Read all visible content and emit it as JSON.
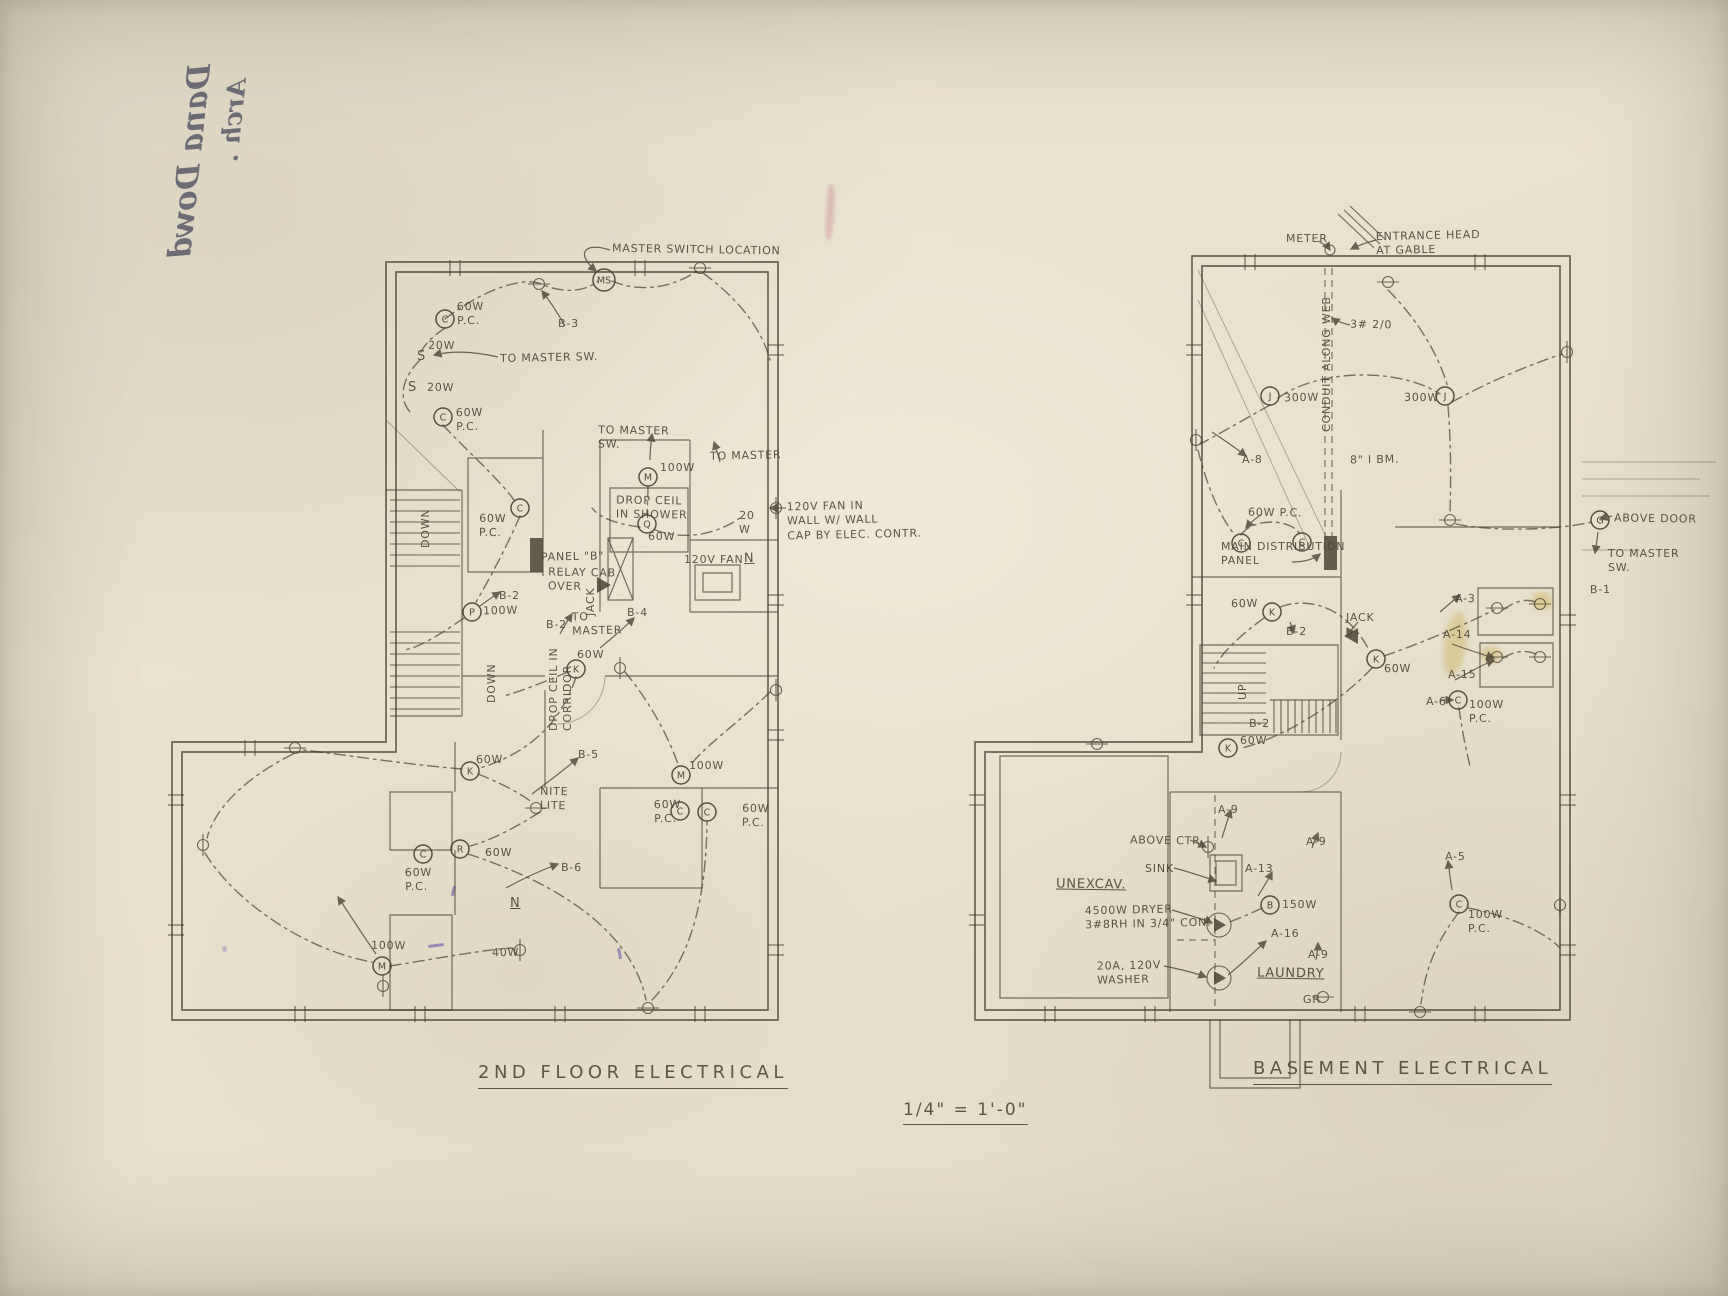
{
  "sheet": {
    "scale_note": "1/4\" = 1'-0\"",
    "handwriting_line1": "Dana Dowd",
    "handwriting_line2": "Arch ."
  },
  "colors": {
    "paper": "#e9e2cf",
    "ink": "#4a4433",
    "stain_yellow": "#c9a33f",
    "ink_purple": "#5a48a8",
    "stamp_pink": "#c06678"
  },
  "plans": [
    {
      "title": "2ND FLOOR ELECTRICAL",
      "labels": [
        {
          "t": "MASTER SWITCH LOCATION",
          "x": 612,
          "y": 243
        },
        {
          "t": "B-3",
          "x": 558,
          "y": 317
        },
        {
          "t": "60W\nP.C.",
          "x": 457,
          "y": 300
        },
        {
          "t": "20W",
          "x": 428,
          "y": 339
        },
        {
          "t": "S",
          "x": 417,
          "y": 349,
          "c": "big"
        },
        {
          "t": "TO MASTER SW.",
          "x": 500,
          "y": 351
        },
        {
          "t": "20W",
          "x": 427,
          "y": 381
        },
        {
          "t": "S",
          "x": 408,
          "y": 380,
          "c": "big"
        },
        {
          "t": "60W\nP.C.",
          "x": 456,
          "y": 406
        },
        {
          "t": "TO MASTER\nSW.",
          "x": 598,
          "y": 424
        },
        {
          "t": "100W",
          "x": 660,
          "y": 461
        },
        {
          "t": "TO MASTER",
          "x": 710,
          "y": 449
        },
        {
          "t": "DROP CEIL\nIN SHOWER",
          "x": 616,
          "y": 494
        },
        {
          "t": "60W",
          "x": 648,
          "y": 530
        },
        {
          "t": "120V FAN IN\nWALL W/ WALL\nCAP BY ELEC. CONTR.",
          "x": 787,
          "y": 499
        },
        {
          "t": "20\nW",
          "x": 739,
          "y": 509
        },
        {
          "t": "120V FAN",
          "x": 684,
          "y": 553
        },
        {
          "t": "N",
          "x": 744,
          "y": 551,
          "c": "big u"
        },
        {
          "t": "60W\nP.C.",
          "x": 479,
          "y": 512
        },
        {
          "t": "DOWN",
          "x": 419,
          "y": 548,
          "c": "v"
        },
        {
          "t": "PANEL \"B\"",
          "x": 541,
          "y": 550
        },
        {
          "t": "RELAY CAB.\nOVER",
          "x": 548,
          "y": 566
        },
        {
          "t": "B-2",
          "x": 499,
          "y": 589
        },
        {
          "t": "100W",
          "x": 483,
          "y": 604
        },
        {
          "t": "JACK",
          "x": 584,
          "y": 616,
          "c": "v"
        },
        {
          "t": "B-2",
          "x": 546,
          "y": 618
        },
        {
          "t": "TO\nMASTER",
          "x": 572,
          "y": 610
        },
        {
          "t": "B-4",
          "x": 627,
          "y": 606
        },
        {
          "t": "60W",
          "x": 577,
          "y": 648
        },
        {
          "t": "DROP CEIL IN\nCORRIDOR",
          "x": 547,
          "y": 731,
          "c": "v"
        },
        {
          "t": "DOWN",
          "x": 485,
          "y": 703,
          "c": "v"
        },
        {
          "t": "B-5",
          "x": 578,
          "y": 748
        },
        {
          "t": "60W",
          "x": 476,
          "y": 753
        },
        {
          "t": "NITE\nLITE",
          "x": 540,
          "y": 785
        },
        {
          "t": "100W",
          "x": 689,
          "y": 759
        },
        {
          "t": "60W\nP.C.",
          "x": 654,
          "y": 798
        },
        {
          "t": "60W\nP.C.",
          "x": 742,
          "y": 802
        },
        {
          "t": "60W",
          "x": 485,
          "y": 846
        },
        {
          "t": "60W\nP.C.",
          "x": 405,
          "y": 866
        },
        {
          "t": "B-6",
          "x": 561,
          "y": 861
        },
        {
          "t": "N",
          "x": 510,
          "y": 896,
          "c": "big u"
        },
        {
          "t": "40W",
          "x": 492,
          "y": 946
        },
        {
          "t": "100W",
          "x": 371,
          "y": 939
        }
      ],
      "fixtures": [
        {
          "l": "C",
          "x": 445,
          "y": 319
        },
        {
          "l": "MS",
          "x": 604,
          "y": 280,
          "r": 11
        },
        {
          "l": "C",
          "x": 443,
          "y": 417
        },
        {
          "l": "C",
          "x": 520,
          "y": 508
        },
        {
          "l": "M",
          "x": 648,
          "y": 477
        },
        {
          "l": "Q",
          "x": 647,
          "y": 524
        },
        {
          "l": "P",
          "x": 472,
          "y": 612
        },
        {
          "l": "K",
          "x": 576,
          "y": 669
        },
        {
          "l": "K",
          "x": 470,
          "y": 771
        },
        {
          "l": "M",
          "x": 681,
          "y": 775
        },
        {
          "l": "C",
          "x": 680,
          "y": 811
        },
        {
          "l": "C",
          "x": 707,
          "y": 812
        },
        {
          "l": "R",
          "x": 460,
          "y": 849
        },
        {
          "l": "C",
          "x": 423,
          "y": 854
        },
        {
          "l": "M",
          "x": 382,
          "y": 966
        }
      ]
    },
    {
      "title": "BASEMENT ELECTRICAL",
      "labels": [
        {
          "t": "METER",
          "x": 1286,
          "y": 232
        },
        {
          "t": "ENTRANCE HEAD\nAT GABLE",
          "x": 1376,
          "y": 229
        },
        {
          "t": "3# 2/0",
          "x": 1350,
          "y": 318
        },
        {
          "t": "CONDUIT ALONG WEB",
          "x": 1320,
          "y": 432,
          "c": "v"
        },
        {
          "t": "300W",
          "x": 1284,
          "y": 391
        },
        {
          "t": "300W",
          "x": 1404,
          "y": 391
        },
        {
          "t": "A-8",
          "x": 1242,
          "y": 453
        },
        {
          "t": "8\" I BM.",
          "x": 1350,
          "y": 453
        },
        {
          "t": "ABOVE DOOR",
          "x": 1614,
          "y": 512
        },
        {
          "t": "TO MASTER\nSW.",
          "x": 1608,
          "y": 547
        },
        {
          "t": "B-1",
          "x": 1590,
          "y": 583
        },
        {
          "t": "60W P.C.",
          "x": 1248,
          "y": 506
        },
        {
          "t": "MAIN DISTRIBUTION\nPANEL",
          "x": 1221,
          "y": 540
        },
        {
          "t": "60W",
          "x": 1231,
          "y": 597
        },
        {
          "t": "B-2",
          "x": 1286,
          "y": 625
        },
        {
          "t": "JACK",
          "x": 1346,
          "y": 611
        },
        {
          "t": "60W",
          "x": 1384,
          "y": 662
        },
        {
          "t": "A-3",
          "x": 1455,
          "y": 592
        },
        {
          "t": "A-14",
          "x": 1443,
          "y": 628
        },
        {
          "t": "A-15",
          "x": 1448,
          "y": 668
        },
        {
          "t": "A-6",
          "x": 1426,
          "y": 695
        },
        {
          "t": "100W\nP.C.",
          "x": 1469,
          "y": 698
        },
        {
          "t": "UP",
          "x": 1236,
          "y": 700,
          "c": "v"
        },
        {
          "t": "B-2",
          "x": 1249,
          "y": 717
        },
        {
          "t": "60W",
          "x": 1240,
          "y": 734
        },
        {
          "t": "A-9",
          "x": 1218,
          "y": 803
        },
        {
          "t": "ABOVE CTR.",
          "x": 1130,
          "y": 834
        },
        {
          "t": "SINK",
          "x": 1145,
          "y": 862
        },
        {
          "t": "A-9",
          "x": 1306,
          "y": 835
        },
        {
          "t": "UNEXCAV.",
          "x": 1056,
          "y": 877,
          "c": "u big"
        },
        {
          "t": "A-13",
          "x": 1245,
          "y": 862
        },
        {
          "t": "4500W DRYER\n3#8RH IN 3/4\" CON.",
          "x": 1085,
          "y": 903
        },
        {
          "t": "150W",
          "x": 1282,
          "y": 898
        },
        {
          "t": "A-16",
          "x": 1271,
          "y": 927
        },
        {
          "t": "20A, 120V\nWASHER",
          "x": 1097,
          "y": 959
        },
        {
          "t": "LAUNDRY",
          "x": 1257,
          "y": 966,
          "c": "u big"
        },
        {
          "t": "A-9",
          "x": 1308,
          "y": 948
        },
        {
          "t": "GR",
          "x": 1303,
          "y": 993
        },
        {
          "t": "A-5",
          "x": 1445,
          "y": 850
        },
        {
          "t": "100W\nP.C.",
          "x": 1468,
          "y": 908
        }
      ],
      "fixtures": [
        {
          "l": "J",
          "x": 1270,
          "y": 396
        },
        {
          "l": "J",
          "x": 1445,
          "y": 396
        },
        {
          "l": "C",
          "x": 1241,
          "y": 543
        },
        {
          "l": "C",
          "x": 1302,
          "y": 542
        },
        {
          "l": "K",
          "x": 1272,
          "y": 612
        },
        {
          "l": "K",
          "x": 1376,
          "y": 659
        },
        {
          "l": "K",
          "x": 1228,
          "y": 748
        },
        {
          "l": "G",
          "x": 1600,
          "y": 520
        },
        {
          "l": "C",
          "x": 1458,
          "y": 700
        },
        {
          "l": "B",
          "x": 1270,
          "y": 905
        },
        {
          "l": "C",
          "x": 1459,
          "y": 904
        }
      ]
    }
  ]
}
